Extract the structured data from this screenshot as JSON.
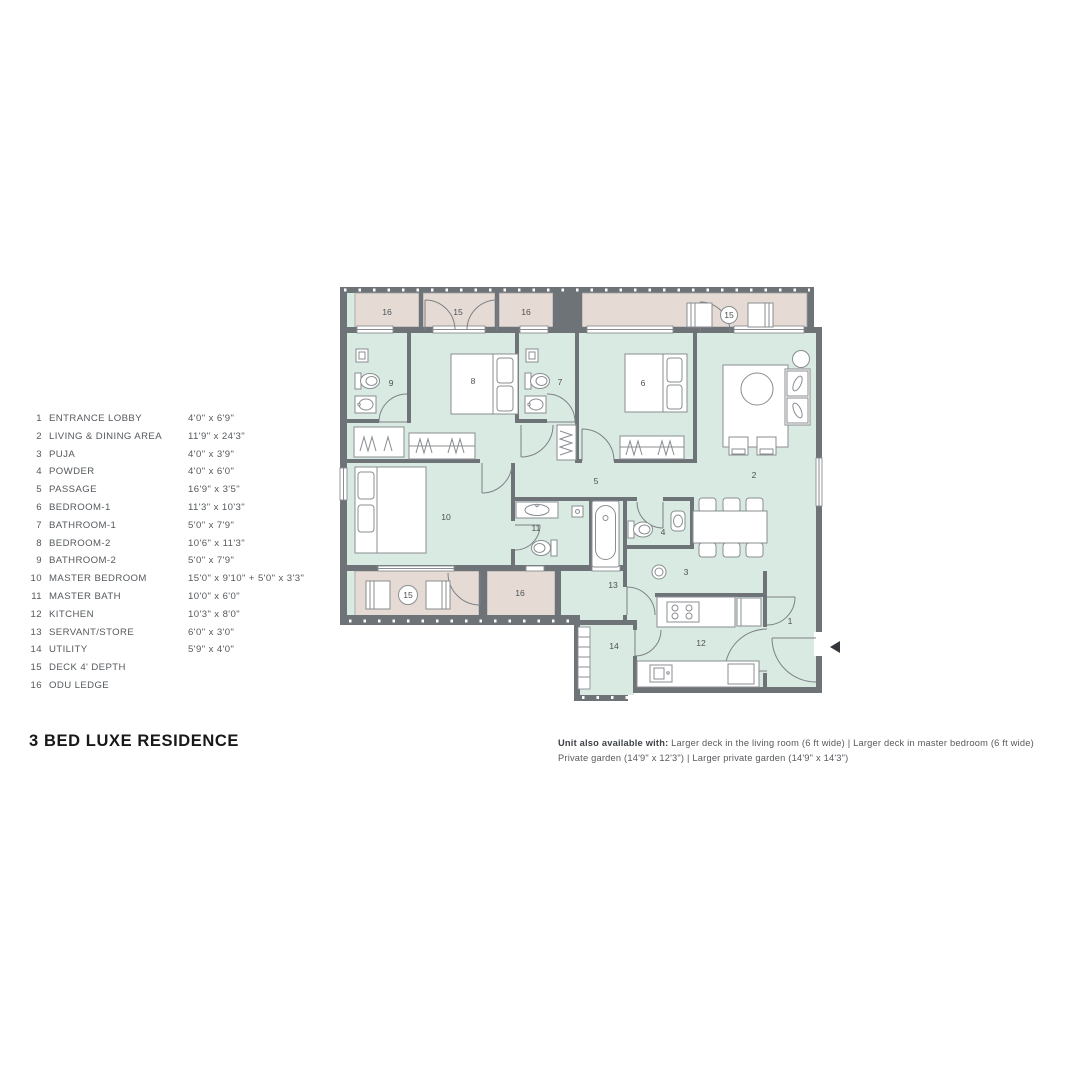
{
  "title": "3 BED LUXE RESIDENCE",
  "legend": {
    "items": [
      {
        "num": "1",
        "name": "ENTRANCE LOBBY",
        "dims": "4'0\" x 6'9\""
      },
      {
        "num": "2",
        "name": "LIVING & DINING AREA",
        "dims": "11'9\" x 24'3\""
      },
      {
        "num": "3",
        "name": "PUJA",
        "dims": "4'0\" x 3'9\""
      },
      {
        "num": "4",
        "name": "POWDER",
        "dims": "4'0\" x 6'0\""
      },
      {
        "num": "5",
        "name": "PASSAGE",
        "dims": "16'9\" x 3'5\""
      },
      {
        "num": "6",
        "name": "BEDROOM-1",
        "dims": "11'3\" x 10'3\""
      },
      {
        "num": "7",
        "name": "BATHROOM-1",
        "dims": "5'0\" x 7'9\""
      },
      {
        "num": "8",
        "name": "BEDROOM-2",
        "dims": "10'6\" x 11'3\""
      },
      {
        "num": "9",
        "name": "BATHROOM-2",
        "dims": "5'0\" x 7'9\""
      },
      {
        "num": "10",
        "name": "MASTER BEDROOM",
        "dims": "15'0\" x 9'10\" + 5'0\" x 3'3\""
      },
      {
        "num": "11",
        "name": "MASTER BATH",
        "dims": "10'0\" x 6'0\""
      },
      {
        "num": "12",
        "name": "KITCHEN",
        "dims": "10'3\" x 8'0\""
      },
      {
        "num": "13",
        "name": "SERVANT/STORE",
        "dims": "6'0\" x 3'0\""
      },
      {
        "num": "14",
        "name": "UTILITY",
        "dims": "5'9\" x 4'0\""
      },
      {
        "num": "15",
        "name": "DECK 4' DEPTH",
        "dims": ""
      },
      {
        "num": "16",
        "name": "ODU LEDGE",
        "dims": ""
      }
    ]
  },
  "note": {
    "bold": "Unit also available with:",
    "line1_rest": " Larger deck in the living room (6 ft wide) | Larger deck in master bedroom (6 ft wide)",
    "line2": "Private garden (14'9\" x 12'3\") | Larger private garden (14'9\" x 14'3\")"
  },
  "plan": {
    "labels": {
      "r1": "1",
      "r2": "2",
      "r3": "3",
      "r4": "4",
      "r5": "5",
      "r6": "6",
      "r7": "7",
      "r8": "8",
      "r9": "9",
      "r10": "10",
      "r11": "11",
      "r12": "12",
      "r13": "13",
      "r14": "14",
      "deck": "15",
      "odu": "16"
    }
  },
  "colors": {
    "wall": "#6e7377",
    "room": "#d9eae2",
    "deck": "#e6dbd4",
    "accent_text": "#17181a"
  }
}
